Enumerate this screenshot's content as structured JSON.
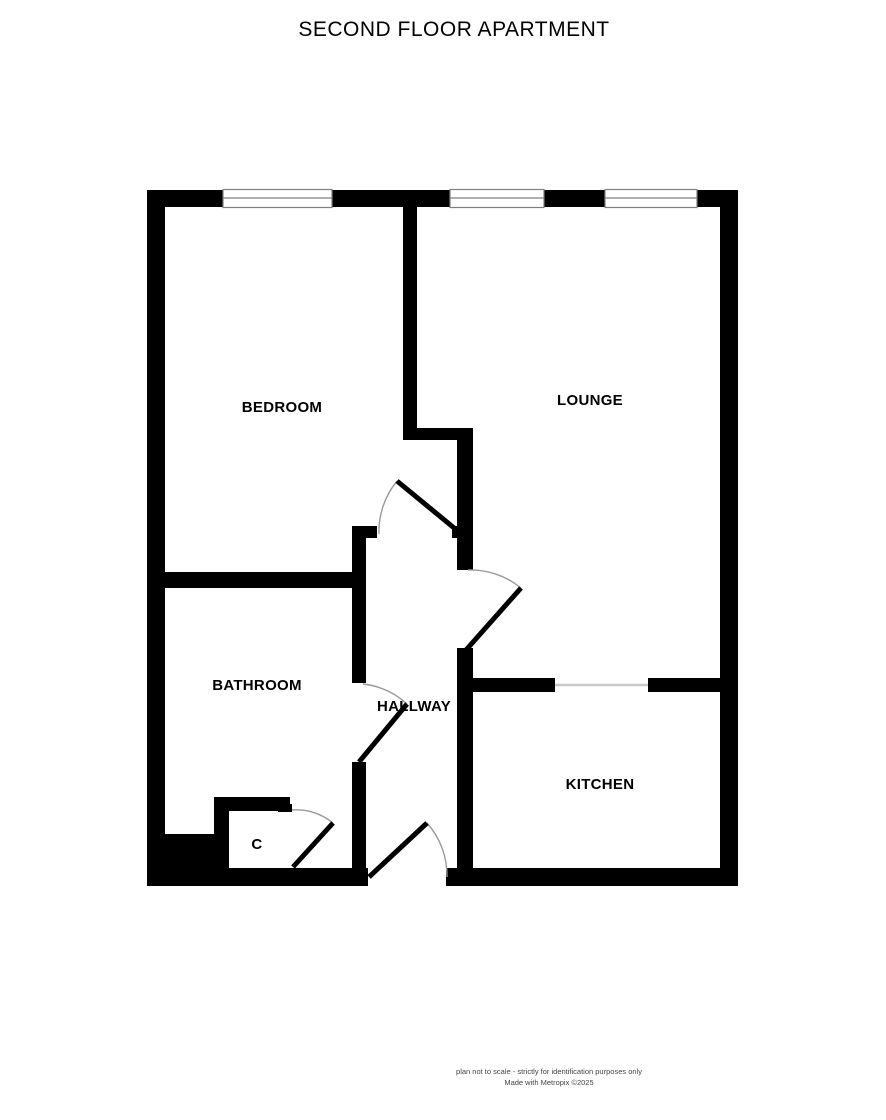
{
  "title": "SECOND FLOOR APARTMENT",
  "rooms": {
    "bedroom": {
      "label": "BEDROOM"
    },
    "lounge": {
      "label": "LOUNGE"
    },
    "bathroom": {
      "label": "BATHROOM"
    },
    "hallway": {
      "label": "HALLWAY"
    },
    "kitchen": {
      "label": "KITCHEN"
    },
    "cupboard": {
      "label": "C"
    }
  },
  "features": {
    "windows_top_wall": 3,
    "doors": [
      "bedroom-door",
      "lounge-door",
      "bathroom-door",
      "cupboard-door",
      "entrance-door"
    ]
  },
  "footer": {
    "line1": "plan not to scale - strictly for identification purposes only",
    "line2": "Made with Metropix ©2025"
  },
  "colors": {
    "wall": "#000000",
    "window_outline": "#7f7f7f",
    "open_plan_divider": "#c8c8c8",
    "door_arc": "#9a9a9a",
    "label_text": "#000000",
    "footer_text": "#444444",
    "background": "#ffffff"
  }
}
